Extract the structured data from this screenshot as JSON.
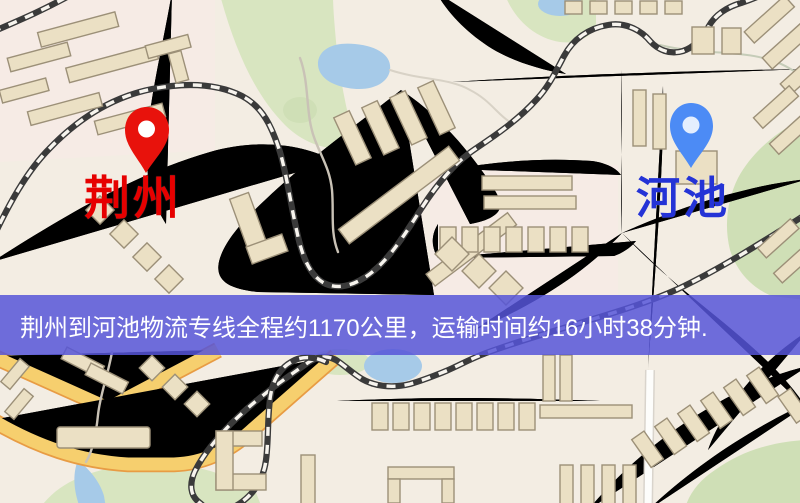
{
  "banner": {
    "text": "荆州到河池物流专线全程约1170公里，运输时间约16小时38分钟.",
    "background_color": "#5856d8",
    "text_color": "#ffffff",
    "distance_text": "约1170公里",
    "duration_text": "约16小时38分钟"
  },
  "map": {
    "origin": {
      "name": "荆州",
      "label_color": "#e60000",
      "pin_color": "#e8120c"
    },
    "destination": {
      "name": "河池",
      "label_color": "#2433d6",
      "pin_color": "#4c8bf5"
    },
    "palette": {
      "background": "#f3ede3",
      "road_fill": "#f7d379",
      "road_casing": "#e9ac58",
      "park_green": "#d8e5c0",
      "water_blue": "#a6cae8",
      "building_fill": "#ebe0c4",
      "railway_dark": "#3a3a3a"
    }
  }
}
